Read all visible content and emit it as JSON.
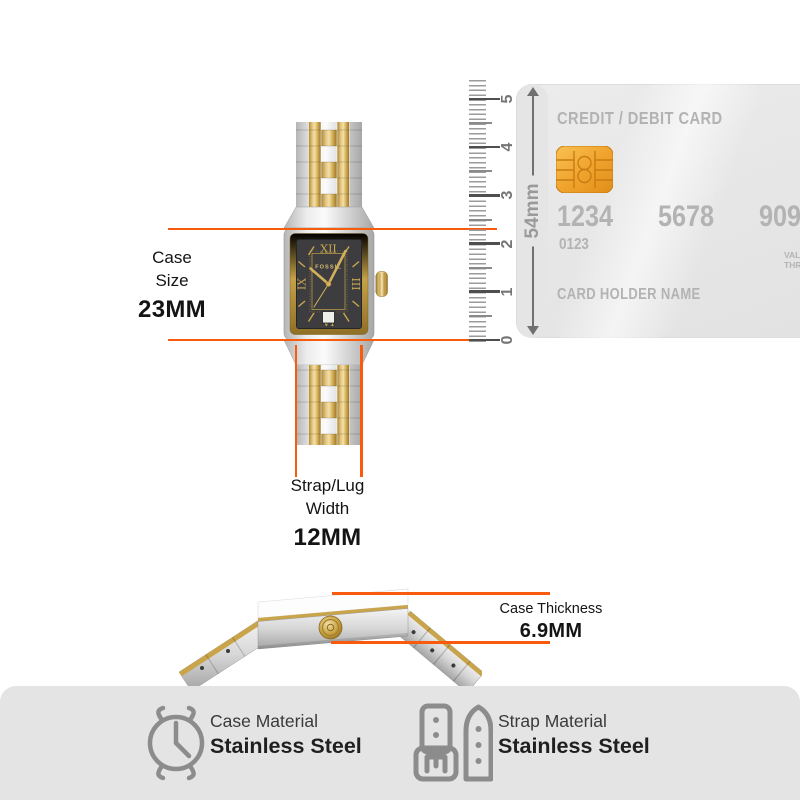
{
  "labels": {
    "case_size": {
      "line1": "Case",
      "line2": "Size",
      "value": "23MM"
    },
    "strap_width": {
      "line1": "Strap/Lug",
      "line2": "Width",
      "value": "12MM"
    },
    "case_thickness": {
      "label": "Case Thickness",
      "value": "6.9MM"
    }
  },
  "ruler": {
    "unit": "54mm",
    "ticks": [
      "0",
      "1",
      "2",
      "3",
      "4",
      "5"
    ]
  },
  "card": {
    "title": "CREDIT / DEBIT CARD",
    "numbers": [
      "1234",
      "5678",
      "9098"
    ],
    "sub_number": "0123",
    "holder": "CARD HOLDER NAME",
    "valid1": "VALID",
    "valid2": "THRU"
  },
  "dial": {
    "brand": "FOSSIL",
    "n12": "XII",
    "n3": "III",
    "n6": "VI",
    "n9": "IX"
  },
  "materials": {
    "case": {
      "label": "Case Material",
      "value": "Stainless Steel"
    },
    "strap": {
      "label": "Strap Material",
      "value": "Stainless Steel"
    }
  },
  "colors": {
    "accent_orange": "#F95B0E",
    "gold": "#D2AC56",
    "panel_gray": "#E4E4E4",
    "card_text_gray": "#B3B3B3",
    "icon_gray": "#8C8C8C"
  }
}
